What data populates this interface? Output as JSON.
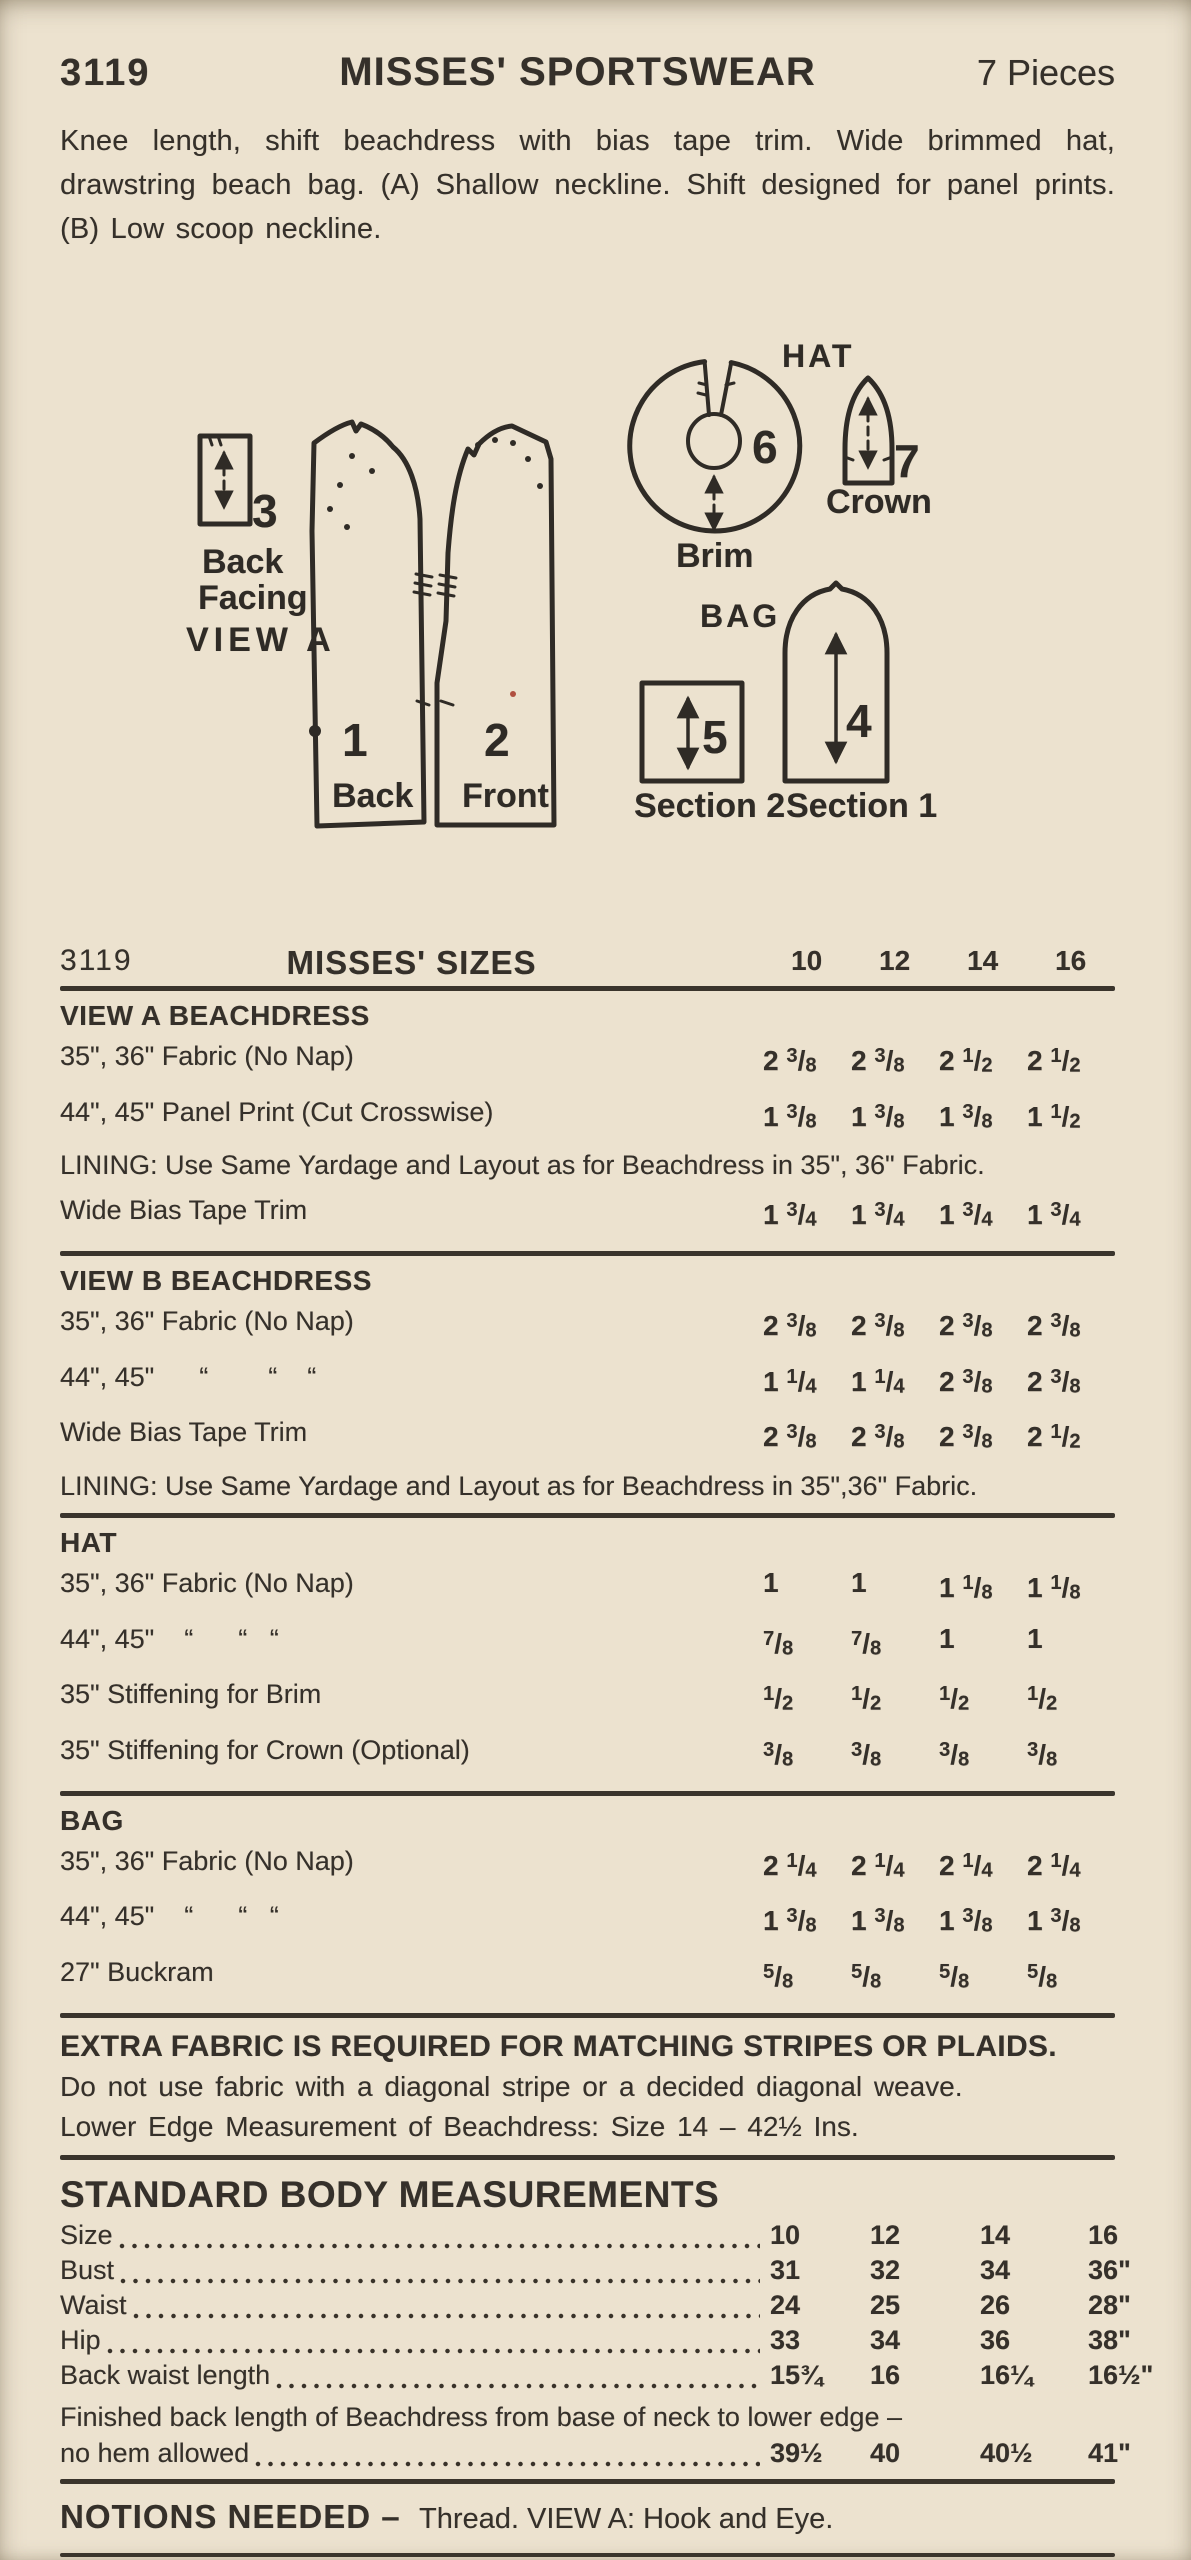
{
  "header": {
    "pattern_number": "3119",
    "title": "MISSES' SPORTSWEAR",
    "pieces": "7 Pieces"
  },
  "description": "Knee length, shift beachdress with bias tape trim. Wide brimmed hat, drawstring beach bag. (A) Shallow neckline. Shift designed for panel prints. (B) Low scoop neckline.",
  "diagram": {
    "view_a": {
      "number": "3",
      "label_line1": "Back",
      "label_line2": "Facing",
      "label_line3": "VIEW A"
    },
    "dress": {
      "back_number": "1",
      "back_label": "Back",
      "front_number": "2",
      "front_label": "Front"
    },
    "hat": {
      "group": "HAT",
      "brim_number": "6",
      "brim_label": "Brim",
      "crown_number": "7",
      "crown_label": "Crown"
    },
    "bag": {
      "group": "BAG",
      "section2_number": "5",
      "section2_label": "Section 2",
      "section1_number": "4",
      "section1_label": "Section 1"
    }
  },
  "yardage": {
    "pattern_number": "3119",
    "title": "MISSES' SIZES",
    "sizes": [
      "10",
      "12",
      "14",
      "16"
    ],
    "sections": [
      {
        "heading": "VIEW A  BEACHDRESS",
        "rows": [
          {
            "label": "35\", 36\" Fabric (No Nap)",
            "values": [
              "2 3/8",
              "2 3/8",
              "2 1/2",
              "2 1/2"
            ]
          },
          {
            "label": "44\", 45\" Panel Print (Cut Crosswise)",
            "values": [
              "1 3/8",
              "1 3/8",
              "1 3/8",
              "1 1/2"
            ]
          }
        ],
        "note": "LINING: Use Same Yardage and Layout as for Beachdress in 35\", 36\" Fabric.",
        "rows2": [
          {
            "label": "Wide Bias Tape Trim",
            "values": [
              "1 3/4",
              "1 3/4",
              "1 3/4",
              "1 3/4"
            ]
          }
        ]
      },
      {
        "heading": "VIEW B  BEACHDRESS",
        "rows": [
          {
            "label": "35\", 36\" Fabric (No Nap)",
            "values": [
              "2 3/8",
              "2 3/8",
              "2 3/8",
              "2 3/8"
            ]
          },
          {
            "label": "44\", 45\"      “        “    “",
            "values": [
              "1 1/4",
              "1 1/4",
              "2 3/8",
              "2 3/8"
            ]
          },
          {
            "label": "Wide Bias Tape Trim",
            "values": [
              "2 3/8",
              "2 3/8",
              "2 3/8",
              "2 1/2"
            ]
          }
        ],
        "note": "LINING: Use Same Yardage and Layout as for Beachdress in 35\",36\" Fabric.",
        "rows2": []
      },
      {
        "heading": "HAT",
        "rows": [
          {
            "label": "35\", 36\" Fabric (No Nap)",
            "values": [
              "1",
              "1",
              "1 1/8",
              "1 1/8"
            ]
          },
          {
            "label": "44\", 45\"    “      “   “",
            "values": [
              "7/8",
              "7/8",
              "1",
              "1"
            ]
          },
          {
            "label": "35\" Stiffening for Brim",
            "values": [
              "1/2",
              "1/2",
              "1/2",
              "1/2"
            ]
          },
          {
            "label": "35\" Stiffening for Crown (Optional)",
            "values": [
              "3/8",
              "3/8",
              "3/8",
              "3/8"
            ]
          }
        ],
        "note": "",
        "rows2": []
      },
      {
        "heading": "BAG",
        "rows": [
          {
            "label": "35\", 36\" Fabric (No Nap)",
            "values": [
              "2 1/4",
              "2 1/4",
              "2 1/4",
              "2 1/4"
            ]
          },
          {
            "label": "44\", 45\"    “      “   “",
            "values": [
              "1 3/8",
              "1 3/8",
              "1 3/8",
              "1 3/8"
            ]
          },
          {
            "label": "27\" Buckram",
            "values": [
              "5/8",
              "5/8",
              "5/8",
              "5/8"
            ]
          }
        ],
        "note": "",
        "rows2": []
      }
    ]
  },
  "extra_notes": {
    "line1": "EXTRA FABRIC IS REQUIRED FOR MATCHING STRIPES OR PLAIDS.",
    "line2": "Do not use fabric with a diagonal stripe or a decided diagonal weave.",
    "line3": "Lower Edge Measurement of Beachdress: Size 14 – 42½ Ins."
  },
  "measurements": {
    "title": "STANDARD BODY MEASUREMENTS",
    "rows": [
      {
        "label": "Size",
        "values": [
          "10",
          "12",
          "14",
          "16"
        ]
      },
      {
        "label": "Bust",
        "values": [
          "31",
          "32",
          "34",
          "36\""
        ]
      },
      {
        "label": "Waist",
        "values": [
          "24",
          "25",
          "26",
          "28\""
        ]
      },
      {
        "label": "Hip",
        "values": [
          "33",
          "34",
          "36",
          "38\""
        ]
      },
      {
        "label": "Back waist length",
        "values": [
          "15¾",
          "16",
          "16¼",
          "16½\""
        ]
      }
    ],
    "finished_note": "Finished back length of Beachdress from base of neck to lower edge –",
    "finished_row": {
      "label": "no hem allowed",
      "values": [
        "39½",
        "40",
        "40½",
        "41\""
      ]
    }
  },
  "notions": {
    "title": "NOTIONS NEEDED –",
    "text": "Thread. VIEW A: Hook and Eye."
  },
  "fabrics": {
    "title": "SUGGESTED  FABRICS –",
    "line1": "Ginghams, Denims, Poplins, Sailcloths,",
    "line2": "Panel Prints."
  }
}
